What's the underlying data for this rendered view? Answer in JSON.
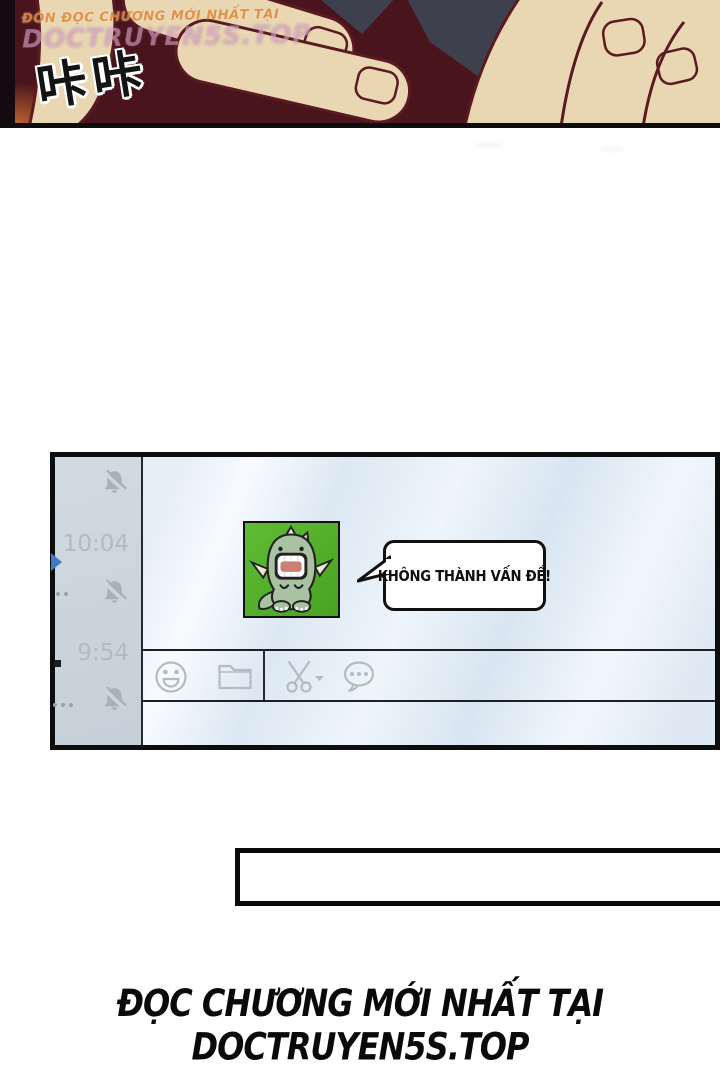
{
  "watermark": {
    "line1": "ĐÓN ĐỌC CHƯƠNG MỚI NHẤT TẠI",
    "line2": "DOCTRUYEN5S.TOP"
  },
  "sfx": "咔咔",
  "chat_window": {
    "sidebar": {
      "rows": [
        {
          "time": "10:04",
          "muted": true
        },
        {
          "time": "9:54",
          "muted": true
        }
      ]
    },
    "message": {
      "avatar": "green-dinosaur-sticker",
      "bubble_text": "KHÔNG THÀNH VẤN ĐỀ!"
    },
    "toolbar": {
      "icons": [
        "emoji",
        "folder",
        "scissors",
        "chat-history"
      ]
    }
  },
  "footer": "ĐỌC CHƯƠNG MỚI NHẤT TẠI DOCTRUYEN5S.TOP",
  "colors": {
    "avatar_green": "#54b52c",
    "sidebar_bg": "#ccd6de",
    "main_bg": "#e3edf7",
    "timestamp": "#b2bac3",
    "icon_gray": "#b4bbc3",
    "panel_maroon": "#4a141d"
  }
}
